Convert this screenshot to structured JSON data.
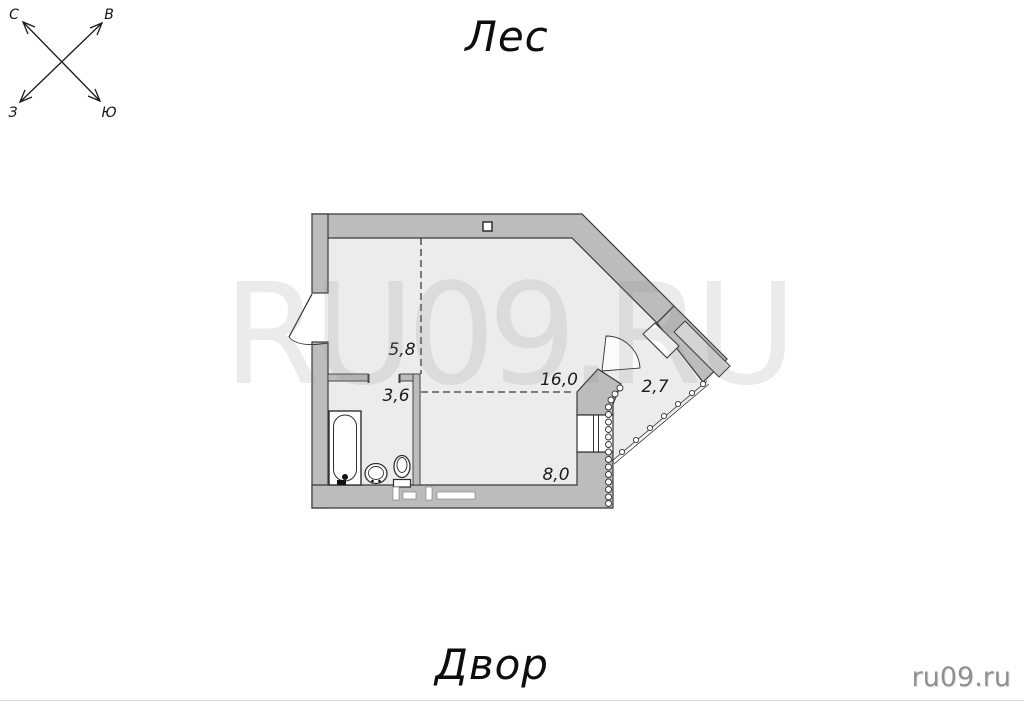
{
  "orientation": {
    "top_label": "Лес",
    "bottom_label": "Двор"
  },
  "compass": {
    "north": "С",
    "east": "В",
    "west": "З",
    "south": "Ю"
  },
  "floor_plan": {
    "rooms": [
      {
        "name": "hallway",
        "area": "5,8"
      },
      {
        "name": "bathroom",
        "area": "3,6"
      },
      {
        "name": "living-room",
        "area": "16,0"
      },
      {
        "name": "balcony",
        "area": "2,7"
      },
      {
        "name": "lower-room",
        "area": "8,0"
      }
    ],
    "colors": {
      "wall_fill": "#bcbcbc",
      "interior_fill": "#ececec",
      "outline": "#383838",
      "balcony_glazing": "#d4d4d4",
      "fixture_fill": "#ffffff"
    }
  },
  "watermark": {
    "text": "RU09.RU"
  },
  "branding": {
    "site": "ru09.ru"
  }
}
